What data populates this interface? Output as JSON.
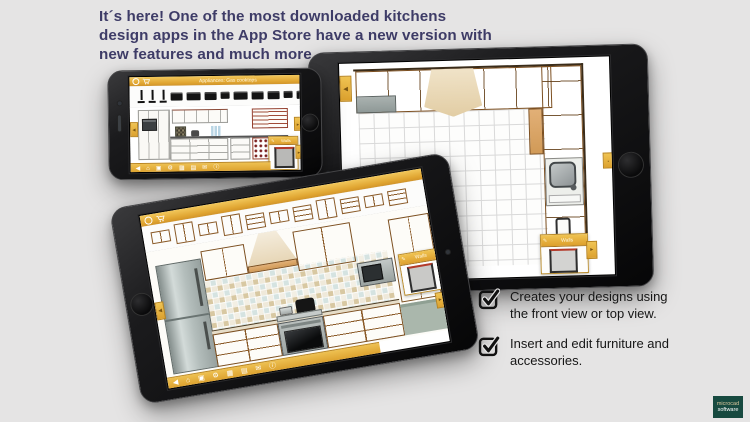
{
  "headline": {
    "text": "It´s here! One of the most downloaded kitchens design apps in the App Store have a new version with new features and much more.",
    "color": "#3e3c67"
  },
  "checklist": {
    "items": [
      {
        "text": "Creates your designs using the front view or top view."
      },
      {
        "text": "Insert and edit furniture and accessories."
      }
    ]
  },
  "logo": {
    "line1": "microcad",
    "line2": "software",
    "background": "#174a40"
  },
  "app": {
    "accent_yellow": "#e4ab34",
    "topbar_title": "Appliances: Gas cooktops",
    "panel_title": "Walls",
    "toolbar_icons": [
      {
        "glyph": "◀",
        "name": "back-tab-icon"
      },
      {
        "glyph": "⌂",
        "name": "home-icon"
      },
      {
        "glyph": "▣",
        "name": "camera-icon"
      },
      {
        "glyph": "⚙",
        "name": "settings-icon"
      },
      {
        "glyph": "▦",
        "name": "gallery-icon"
      },
      {
        "glyph": "▤",
        "name": "list-icon"
      },
      {
        "glyph": "✉",
        "name": "share-icon"
      },
      {
        "glyph": "ⓘ",
        "name": "info-icon"
      }
    ],
    "phone_thumbs": [
      {
        "type": "faucet"
      },
      {
        "type": "faucet"
      },
      {
        "type": "faucet"
      },
      {
        "type": "appliance"
      },
      {
        "type": "appliance"
      },
      {
        "type": "appliance"
      },
      {
        "type": "appliance"
      },
      {
        "type": "appliance"
      },
      {
        "type": "appliance"
      },
      {
        "type": "appliance"
      },
      {
        "type": "appliance"
      },
      {
        "type": "appliance"
      },
      {
        "type": "appliance"
      },
      {
        "type": "appliance"
      }
    ],
    "tablet_thumbs": [
      {
        "type": "upper"
      },
      {
        "type": "tall"
      },
      {
        "type": "upper"
      },
      {
        "type": "tall"
      },
      {
        "type": "base"
      },
      {
        "type": "upper"
      },
      {
        "type": "base"
      },
      {
        "type": "tall"
      },
      {
        "type": "base"
      },
      {
        "type": "upper"
      },
      {
        "type": "base"
      }
    ]
  }
}
